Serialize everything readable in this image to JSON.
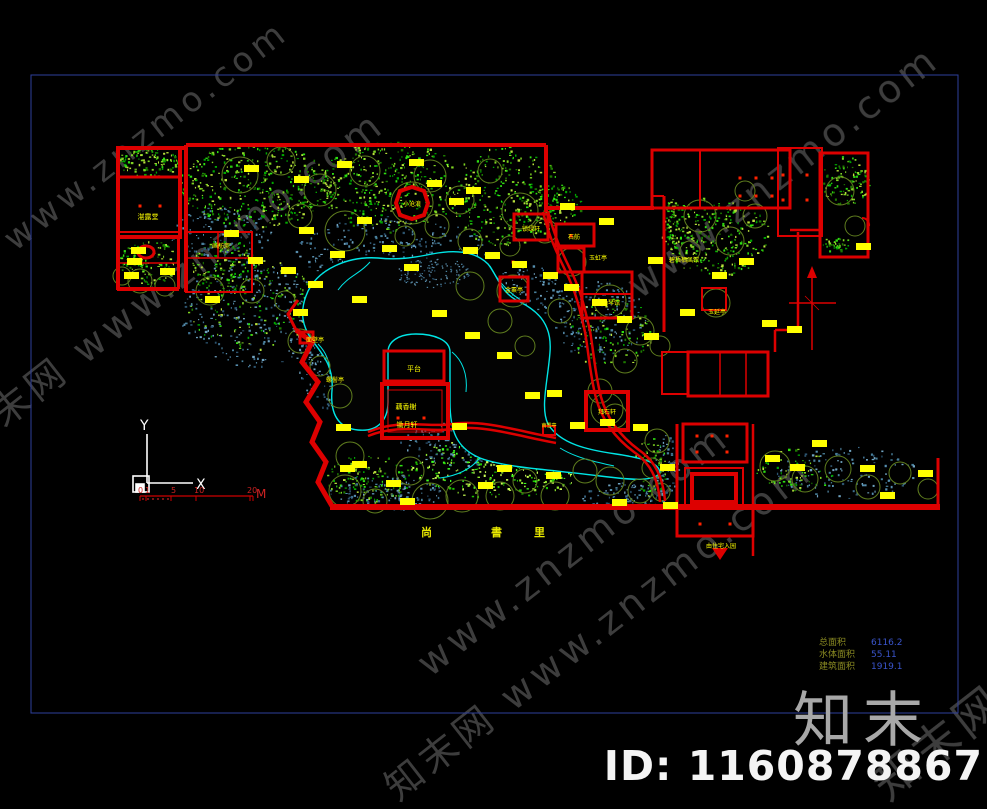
{
  "page": {
    "background": "#000000"
  },
  "colors": {
    "frame": "#2e3f9c",
    "red": "#dd0000",
    "bright_red": "#ff1a00",
    "yellow": "#ffff00",
    "cyan": "#00e5e5",
    "slate": "#4f84a5",
    "green": "#22cc22",
    "olive": "#5f7d1e",
    "white": "#ffffff",
    "watermark": "#6f6f6f",
    "logo_gray": "#a8a8a8",
    "value_blue": "#3a55cc",
    "label_olive": "#8a8a22"
  },
  "watermark": {
    "brand": "知末网",
    "site": "www.znzmo.com",
    "tile_text": "知末网 www.znzmo.com"
  },
  "branding": {
    "logo": "知末",
    "id_label": "ID: 1160878867"
  },
  "info_table": {
    "rows": [
      {
        "label": "总面积",
        "value": "6116.2"
      },
      {
        "label": "水体面积",
        "value": "55.11"
      },
      {
        "label": "建筑面积",
        "value": "1919.1"
      }
    ]
  },
  "street_label": {
    "chars": [
      "尚",
      "書",
      "里"
    ]
  },
  "axis": {
    "x": "X",
    "y": "Y"
  },
  "scale_bar": {
    "ticks": [
      "0",
      "1",
      "5",
      "10",
      "20"
    ],
    "unit": "M"
  },
  "plan": {
    "labels": [
      {
        "text": "湛露堂",
        "x": 148,
        "y": 219,
        "s": 7
      },
      {
        "text": "画舫斋",
        "x": 221,
        "y": 248,
        "s": 6
      },
      {
        "text": "小沧浪",
        "x": 412,
        "y": 206,
        "s": 6
      },
      {
        "text": "锁绿轩",
        "x": 531,
        "y": 231,
        "s": 6
      },
      {
        "text": "石舫",
        "x": 574,
        "y": 239,
        "s": 6
      },
      {
        "text": "玉虹亭",
        "x": 598,
        "y": 260,
        "s": 6
      },
      {
        "text": "金粟亭",
        "x": 514,
        "y": 292,
        "s": 6
      },
      {
        "text": "坡仙琴馆",
        "x": 608,
        "y": 305,
        "s": 6
      },
      {
        "text": "碧梧栖凤馆",
        "x": 684,
        "y": 262,
        "s": 6
      },
      {
        "text": "玉延亭",
        "x": 717,
        "y": 314,
        "s": 6
      },
      {
        "text": "拜石轩",
        "x": 607,
        "y": 414,
        "s": 6
      },
      {
        "text": "面壁亭",
        "x": 315,
        "y": 342,
        "s": 6
      },
      {
        "text": "螺髻亭",
        "x": 335,
        "y": 382,
        "s": 6
      },
      {
        "text": "平台",
        "x": 414,
        "y": 371,
        "s": 7
      },
      {
        "text": "藕香榭",
        "x": 406,
        "y": 409,
        "s": 7
      },
      {
        "text": "锄月轩",
        "x": 407,
        "y": 427,
        "s": 7
      },
      {
        "text": "南雪亭",
        "x": 549,
        "y": 427,
        "s": 5
      },
      {
        "text": "由住宅入园",
        "x": 721,
        "y": 548,
        "s": 6
      }
    ]
  }
}
